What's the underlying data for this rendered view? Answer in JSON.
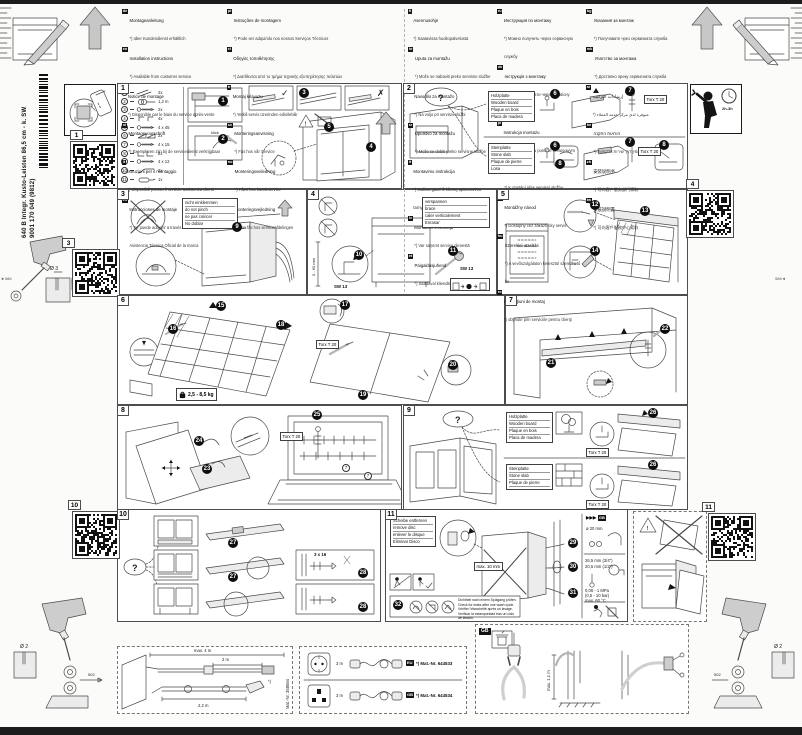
{
  "masthead": {
    "model": "640 B Integr. Kusto-Leisten 86,5 cm - k. SW",
    "code": "9001 170 049 (9812)"
  },
  "languages": {
    "columns": [
      [
        {
          "code": "de",
          "title": "Montageanleitung",
          "note": "*) über Kundendienst erhältlich"
        },
        {
          "code": "en",
          "title": "Installation instructions",
          "note": "*) Available from customer service"
        },
        {
          "code": "fr",
          "title": "Notice de montage",
          "note": "*) Disponible par le biais du service après-vente"
        },
        {
          "code": "nl",
          "title": "Montagevoorschrift",
          "note": "*) Exemplaren zijn bij de servicedienst verkrijgbaar"
        },
        {
          "code": "it",
          "title": "Istruzioni per il montaggio",
          "note": "*) Disponibili presso il servizio assistenza clienti"
        },
        {
          "code": "es",
          "title": "Instrucciones de montaje",
          "note": "*) Se puede adquirir a través del Servicio de Asistencia Técnica Oficial de la marca"
        }
      ],
      [
        {
          "code": "pt",
          "title": "Instruções de montagem",
          "note": "*) Pode ser adquirido nos nossos Serviços Técnicos"
        },
        {
          "code": "el",
          "title": "Οδηγίες τοποθέτησης",
          "note": "*) Διατίθενται από το τμήμα τεχνικής εξυπηρέτησης πελατών"
        },
        {
          "code": "tr",
          "title": "Montaj kılavuzu",
          "note": "*) Yetkili servis üzerinden edinilebilir"
        },
        {
          "code": "sv",
          "title": "Monteringsanvisning",
          "note": "*) Fås hos vår Service"
        },
        {
          "code": "no",
          "title": "Monteringsveiledning",
          "note": "*) Fåes hos kundeservice"
        },
        {
          "code": "da",
          "title": "Monteringsvejledning",
          "note": "*) Kan fås hos serviceafdelingen"
        }
      ],
      [
        {
          "code": "fi",
          "title": "Asennusohje",
          "note": "*) Saatavissa huoltopalvelusta"
        },
        {
          "code": "hr",
          "title": "Uputa za montažu",
          "note": "*) Može se nabaviti preko servisne službe"
        },
        {
          "code": "sl",
          "title": "Navodilo za montažo",
          "note": "*) Na voljo pri servisni službi"
        },
        {
          "code": "sr",
          "title": "Uputstvo za montažu",
          "note": "*) Može se dobiti preko servisne službe"
        },
        {
          "code": "lt",
          "title": "Montavimo instrukcija",
          "note": "*) Galima gauti iš klientų aptarnavimo tarnybos"
        },
        {
          "code": "lv",
          "title": "Montāžas instrukcija",
          "note": "*) Var saņemt servisa dienestā"
        },
        {
          "code": "et",
          "title": "Paigaldusjuhend",
          "note": "*) Saadaval klienditeeninduse kaudu"
        }
      ],
      [
        {
          "code": "ru",
          "title": "Инструкция по монтажу",
          "note": "*) Можно получить через сервисную службу"
        },
        {
          "code": "uk",
          "title": "Інструкція з монтажу",
          "note": "*) Можна отримати через сервісну службу"
        },
        {
          "code": "pl",
          "title": "Instrukcja montażu",
          "note": "*) Do uzyskania w punkcie serwisowym"
        },
        {
          "code": "cs",
          "title": "Montážní návod",
          "note": "*) K dostání přes servisní službu"
        },
        {
          "code": "sk",
          "title": "Montážny návod",
          "note": "*) Dostupný cez zákaznícky servis"
        },
        {
          "code": "hu",
          "title": "Szerelési utasítás",
          "note": "*) A vevőszolgálaton keresztül szerezhető be"
        },
        {
          "code": "ro",
          "title": "Instrucţiuni de montaj",
          "note": "*) obţinute prin serviciile pentru clienţi"
        }
      ],
      [
        {
          "code": "bg",
          "title": "Указания за монтаж",
          "note": "*) Получавате чрез сервизната служба"
        },
        {
          "code": "mk",
          "title": "Упатство за монтажа",
          "note": "*) Достапно преку сервисната служба"
        },
        {
          "code": "ar",
          "title": "إرشادات التركيب",
          "note": "*) متوفرة لدى مركز خدمة العملاء"
        },
        {
          "code": "he",
          "title": "הוראות התקנה",
          "note": "*) זמין דרך שירות הלקוחות"
        },
        {
          "code": "zh",
          "title": "安装说明书",
          "note": "*) 可向客户服务部门索取"
        },
        {
          "code": "tw",
          "title": "安裝說明書",
          "note": "*) 可向客戶服務中心索取"
        }
      ]
    ]
  },
  "panel1": {
    "num": "1",
    "klick": "klick",
    "checks": {
      "ok": "✓",
      "no": "✗"
    },
    "steps": {
      "s1": "1",
      "s2": "2",
      "s3": "3",
      "s4": "4",
      "s5": "5"
    },
    "parts": [
      {
        "n": "1",
        "icon": "strip-icon",
        "qty": "2x"
      },
      {
        "n": "2",
        "icon": "cable-icon",
        "qty": "1,2 m"
      },
      {
        "n": "3",
        "icon": "screw-icon",
        "qty": "2x"
      },
      {
        "n": "4",
        "icon": "clip-icon",
        "qty": "4x"
      },
      {
        "n": "5",
        "icon": "screw-icon",
        "qty": "4 x 45"
      },
      {
        "n": "6",
        "icon": "wedge-icon",
        "qty": "2x"
      },
      {
        "n": "7",
        "icon": "screw-icon",
        "qty": "4 x 15"
      },
      {
        "n": "8",
        "icon": "bracket-icon",
        "qty": "2x"
      },
      {
        "n": "9",
        "icon": "screw-icon",
        "qty": "4 x 12"
      },
      {
        "n": "10",
        "icon": "lever-icon",
        "qty": "2x"
      },
      {
        "n": "11",
        "icon": "tube-icon",
        "qty": "1x"
      }
    ]
  },
  "panel2": {
    "num": "2",
    "question": "?",
    "wood": [
      "Holzplatte",
      "Wooden board",
      "Plaque en bois",
      "Placa de madera"
    ],
    "stone": [
      "Steinplatte",
      "Stone slab",
      "Plaque de pierre",
      "Losa"
    ],
    "torx": "Torx T 20",
    "steps": {
      "s6": "6",
      "s7": "7",
      "s8": "8"
    }
  },
  "panel3": {
    "num": "3",
    "labels": [
      "nicht einklemmen",
      "do not pinch",
      "ne pas coincer",
      "No doblar"
    ],
    "steps": {
      "s9": "9"
    }
  },
  "panel4": {
    "num": "4",
    "labels": [
      "verspannen",
      "brace",
      "caler verticalement",
      "Enrasar"
    ],
    "sw": "SW 13",
    "range": "0 - 60 mm",
    "steps": {
      "s10": "10",
      "s11": "11"
    }
  },
  "panel5": {
    "num": "5",
    "steps": {
      "s12": "12",
      "s13": "13",
      "s14": "14"
    }
  },
  "panel6": {
    "num": "6",
    "weight": "2,5 - 8,5 kg",
    "torx": "Torx T 20",
    "steps": {
      "s15": "15",
      "s16": "16",
      "s17": "17",
      "s18": "18",
      "s19": "19",
      "s20": "20"
    }
  },
  "panel7": {
    "num": "7",
    "steps": {
      "s21": "21",
      "s22": "22"
    }
  },
  "panel8": {
    "num": "8",
    "torx": "Torx T 20",
    "part_ref": "7",
    "steps": {
      "s23": "23",
      "s24": "24",
      "s25": "25"
    }
  },
  "panel9": {
    "num": "9",
    "question": "?",
    "wood": [
      "Holzplatte",
      "Wooden board",
      "Plaque en bois",
      "Placa de madera"
    ],
    "stone": [
      "Steinplatte",
      "Stone slab",
      "Plaque de pierre",
      "Losa"
    ],
    "torx": "Torx T 20",
    "steps": {
      "s26": "26"
    }
  },
  "panel10": {
    "num": "10",
    "question": "?",
    "screw": "3 x 16",
    "steps": {
      "s27": "27",
      "s28": "28"
    }
  },
  "panel11": {
    "num": "11",
    "disc": [
      "Scheibe entfernen",
      "remove disc",
      "enlever le disque",
      "Eliminar Disco"
    ],
    "max_bend": "max. 10 mm",
    "leak": [
      "Dichtheit nach einem Spülgang prüfen.",
      "Check for leaks after one wash cycle.",
      "Vérifier l'étanchéité après un lavage.",
      "Verificar la estanqueidad tras un ciclo de lavado."
    ],
    "gb_arrows": "▶▶▶",
    "gb_badge": "GB",
    "hose_dia": "ø 20 mm",
    "fit1": "26,5 mm (3/4\")",
    "fit2": "20,5 mm (1/2\")",
    "p1": "0,05 - 1 MPa",
    "p2": "(0,5 - 10 bar)",
    "temp": "max. 60 °C",
    "steps": {
      "s29": "29",
      "s30": "30",
      "s31": "31",
      "s32": "32"
    }
  },
  "sidebar": {
    "qr_labels": {
      "q1": "1",
      "q3": "3",
      "q4": "4",
      "q10": "10",
      "q11": "11"
    },
    "install_time": "2h-3h",
    "drill_top": {
      "dia": "Ø 3",
      "depth": "≥12"
    },
    "drill_bottom_left": {
      "dia": "Ø 2",
      "mark": "502"
    },
    "drill_bottom_right": {
      "dia": "Ø 2",
      "mark": "502"
    },
    "edge_marks": {
      "left": "►586",
      "right": "586◄"
    }
  },
  "bottom": {
    "hose_kit": {
      "dim_total": "max. 4 m",
      "dim_mid": "2 m",
      "dim_low": "2,2 m",
      "star": "*)",
      "mat": "Mat.-Nr. 358584"
    },
    "cords": {
      "row1": {
        "len": "3 m",
        "badge": "EU",
        "mat": "*) Mat.-Nr. 644533"
      },
      "row2": {
        "len": "3 m",
        "badge": "GB",
        "mat": "*) Mat.-Nr. 644534"
      }
    },
    "gb": {
      "badge": "GB",
      "height": "max. 1,1 m"
    }
  }
}
